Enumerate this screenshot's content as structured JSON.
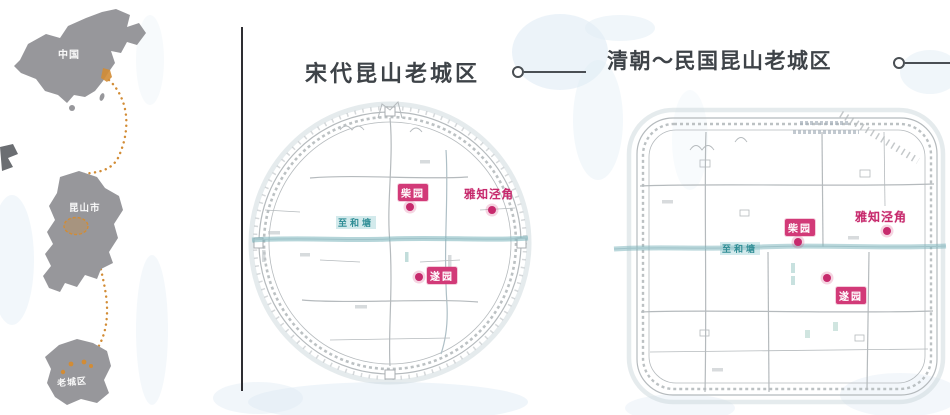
{
  "location_panel": {
    "china_label": "中国",
    "province_label": "昆山市",
    "oldtown_label": "老城区"
  },
  "song_panel": {
    "title": "宋代昆山老城区",
    "canal_label": "至和塘",
    "markers": {
      "chai": "柴园",
      "corner": "雅知泾角",
      "sui": "遂园"
    }
  },
  "qing_panel": {
    "title": "清朝～民国昆山老城区",
    "canal_label": "至和塘",
    "markers": {
      "chai": "柴园",
      "corner": "雅知泾角",
      "sui": "遂园"
    }
  },
  "colors": {
    "title_gray": "#3e4348",
    "marker_pink": "#c72a6d",
    "canal_teal": "#2f8d95",
    "route_orange": "#d28c35",
    "map_gray": "#97979b",
    "sketch_gray": "#b5babd"
  }
}
